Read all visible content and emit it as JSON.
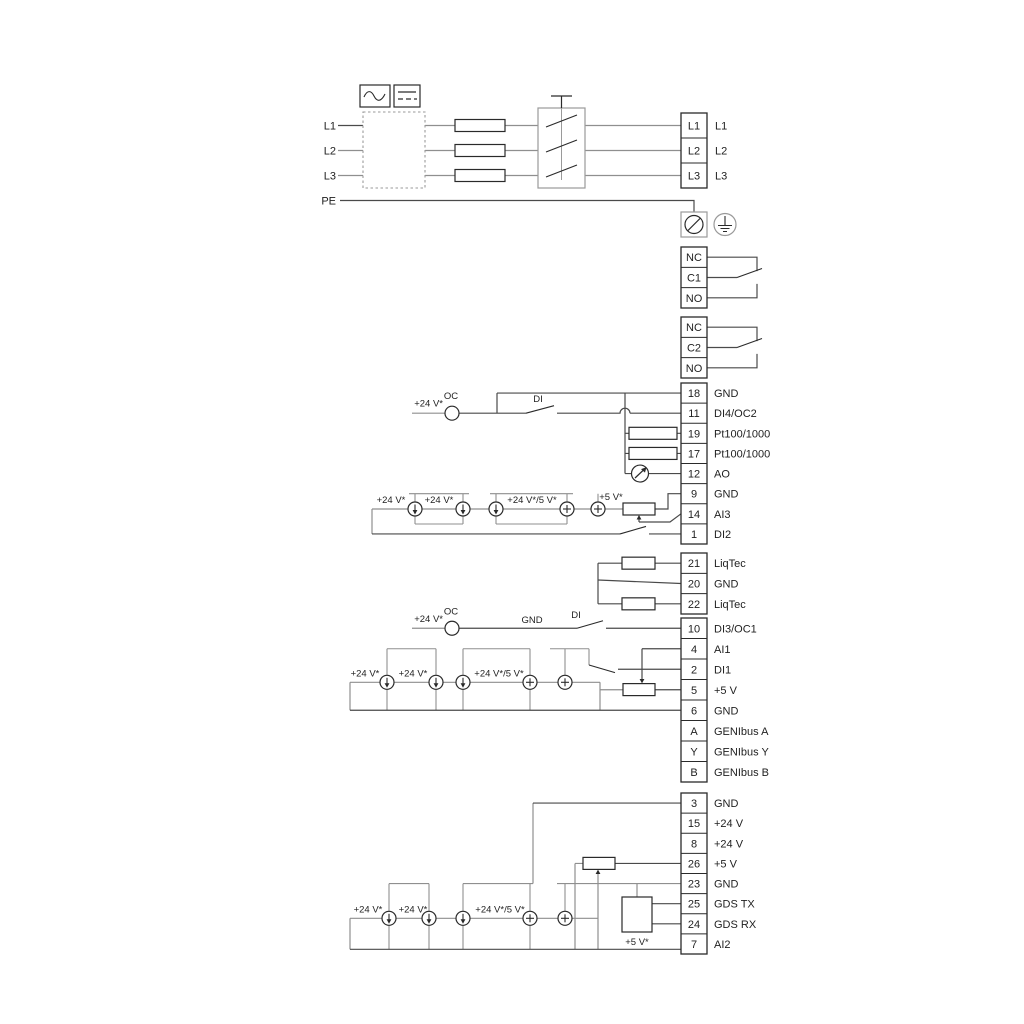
{
  "colors": {
    "wire_gray": "#8f8f8f",
    "wire_dark": "#4a4a4a",
    "symbol": "#2a2a2a",
    "box_gray": "#9a9a9a",
    "text": "#1f1f1f",
    "background": "#ffffff"
  },
  "power_section": {
    "phase_inputs": [
      "L1",
      "L2",
      "L3"
    ],
    "pe_label": "PE",
    "output_terminals": [
      "L1",
      "L2",
      "L3"
    ],
    "converter_icons": [
      "ac-symbol",
      "dc-symbol"
    ]
  },
  "relays": [
    {
      "terminals": [
        "NC",
        "C1",
        "NO"
      ]
    },
    {
      "terminals": [
        "NC",
        "C2",
        "NO"
      ]
    }
  ],
  "terminal_blocks": [
    {
      "id": "io-a",
      "terminals": [
        {
          "no": "18",
          "label": "GND"
        },
        {
          "no": "11",
          "label": "DI4/OC2"
        },
        {
          "no": "19",
          "label": "Pt100/1000"
        },
        {
          "no": "17",
          "label": "Pt100/1000"
        },
        {
          "no": "12",
          "label": "AO"
        },
        {
          "no": "9",
          "label": "GND"
        },
        {
          "no": "14",
          "label": "AI3"
        },
        {
          "no": "1",
          "label": "DI2"
        }
      ]
    },
    {
      "id": "liqtec",
      "terminals": [
        {
          "no": "21",
          "label": "LiqTec"
        },
        {
          "no": "20",
          "label": "GND"
        },
        {
          "no": "22",
          "label": "LiqTec"
        }
      ]
    },
    {
      "id": "io-c",
      "terminals": [
        {
          "no": "10",
          "label": "DI3/OC1"
        },
        {
          "no": "4",
          "label": "AI1"
        },
        {
          "no": "2",
          "label": "DI1"
        },
        {
          "no": "5",
          "label": "+5 V"
        },
        {
          "no": "6",
          "label": "GND"
        },
        {
          "no": "A",
          "label": "GENIbus A"
        },
        {
          "no": "Y",
          "label": "GENIbus Y"
        },
        {
          "no": "B",
          "label": "GENIbus B"
        }
      ]
    },
    {
      "id": "io-d",
      "terminals": [
        {
          "no": "3",
          "label": "GND"
        },
        {
          "no": "15",
          "label": "+24 V"
        },
        {
          "no": "8",
          "label": "+24 V"
        },
        {
          "no": "26",
          "label": "+5 V"
        },
        {
          "no": "23",
          "label": "GND"
        },
        {
          "no": "25",
          "label": "GDS TX"
        },
        {
          "no": "24",
          "label": "GDS RX"
        },
        {
          "no": "7",
          "label": "AI2"
        }
      ]
    }
  ],
  "inline_labels": {
    "v24": "+24 V*",
    "v24v5": "+24 V*/5 V*",
    "v5": "+5 V*",
    "oc": "OC",
    "di": "DI",
    "gnd": "GND"
  }
}
